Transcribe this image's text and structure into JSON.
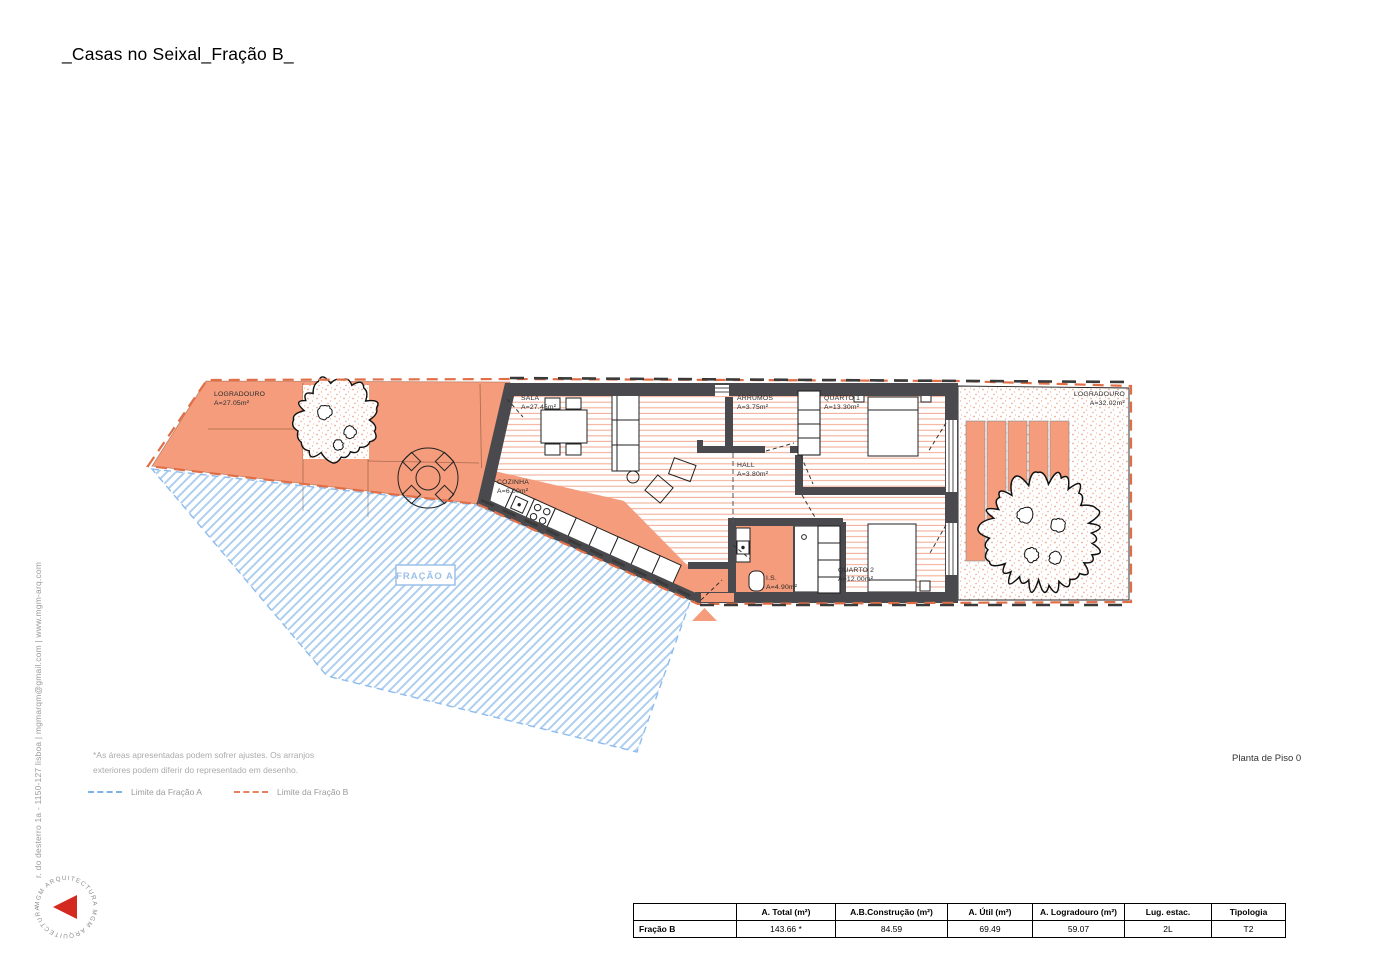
{
  "title": "_Casas no Seixal_Fração B_",
  "sidebar_text": "r. do desterro 1a - 1150-127 lisboa | mgmarqm@gmail.com | www.mgm-arq.com",
  "logo": {
    "ring_text": "MGM ARQUITECTURA   MGM ARQUITECTURA"
  },
  "plan": {
    "colors": {
      "salmon": "#F49C7B",
      "wall": "#4A4A4E",
      "boundary_b_orange": "#E06F48",
      "boundary_a_blue": "#8FBCEC",
      "floor_hatch": "#F2B098",
      "logo_red": "#D3291F"
    },
    "rooms": {
      "logradouro_left": {
        "name": "LOGRADOURO",
        "area": "A=27.05m²"
      },
      "sala": {
        "name": "SALA",
        "area": "A=27.45m²"
      },
      "cozinha": {
        "name": "COZINHA",
        "area": "A=6.00m²"
      },
      "arrumos": {
        "name": "ARRUMOS",
        "area": "A=3.75m²"
      },
      "quarto1": {
        "name": "QUARTO 1",
        "area": "A=13.30m²"
      },
      "hall": {
        "name": "HALL",
        "area": "A=3.80m²"
      },
      "is": {
        "name": "I.S.",
        "area": "A=4.90m²"
      },
      "quarto2": {
        "name": "QUARTO 2",
        "area": "A=12.00m²"
      },
      "logradouro_right": {
        "name": "LOGRADOURO",
        "area": "A=32.02m²"
      },
      "fracao_a": {
        "name": "FRAÇÃO A"
      }
    }
  },
  "notes": {
    "line1": "*As áreas apresentadas podem sofrer ajustes. Os arranjos",
    "line2": "exteriores podem diferir do representado em desenho."
  },
  "legend": [
    {
      "label": "Limite da Fração A",
      "color": "#7FB2E5"
    },
    {
      "label": "Limite da Fração B",
      "color": "#E8805F"
    }
  ],
  "drawing_title": "Planta de Piso 0",
  "table": {
    "headers": [
      "",
      "A. Total (m²)",
      "A.B.Construção (m²)",
      "A. Útil (m²)",
      "A. Logradouro (m²)",
      "Lug. estac.",
      "Tipologia"
    ],
    "rows": [
      [
        "Fração B",
        "143.66 *",
        "84.59",
        "69.49",
        "59.07",
        "2L",
        "T2"
      ]
    ]
  }
}
